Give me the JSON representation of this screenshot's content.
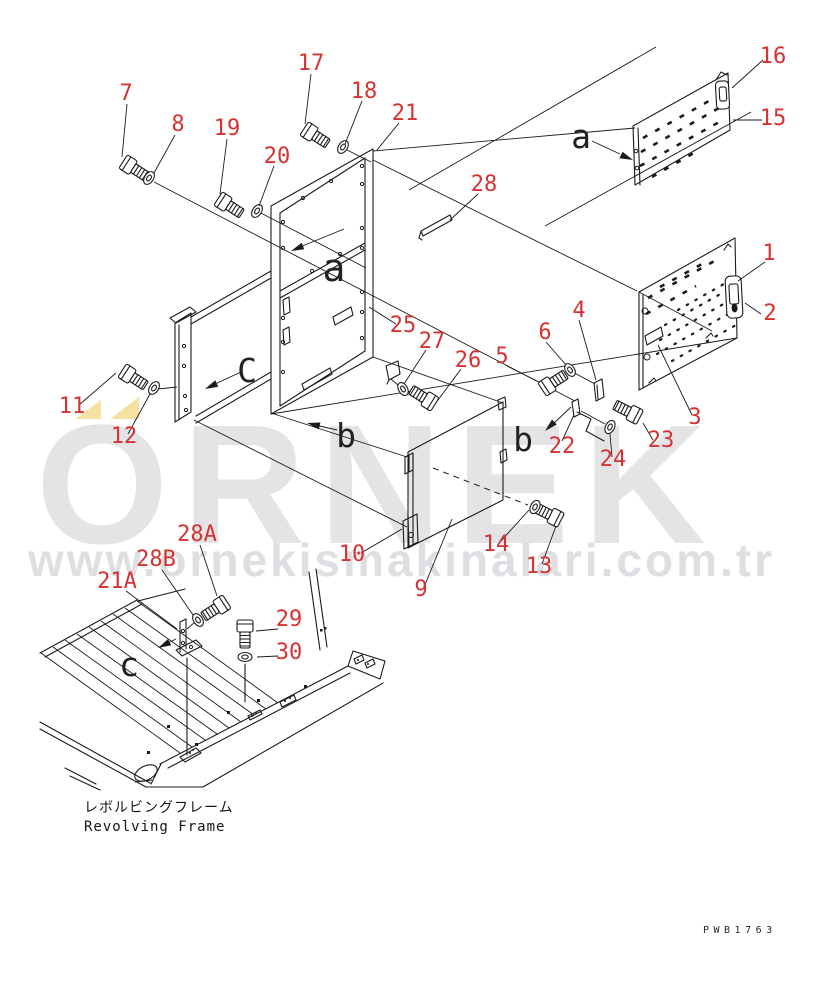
{
  "page": {
    "background": "#ffffff"
  },
  "diagram": {
    "type": "exploded-parts-diagram",
    "subject": {
      "caption_jp": "レボルビングフレーム",
      "caption_en": "Revolving Frame"
    },
    "drawing_number": "PWB1763",
    "colors": {
      "callout": "#d63232",
      "line": "#1b1b1b",
      "letter": "#222222"
    },
    "callouts": [
      "1",
      "2",
      "3",
      "4",
      "5",
      "6",
      "7",
      "8",
      "9",
      "10",
      "11",
      "12",
      "13",
      "14",
      "15",
      "16",
      "17",
      "18",
      "19",
      "20",
      "21",
      "21A",
      "22",
      "23",
      "24",
      "25",
      "26",
      "27",
      "28",
      "28A",
      "28B",
      "29",
      "30"
    ],
    "view_labels": [
      "a",
      "a",
      "b",
      "b",
      "C",
      "c"
    ]
  },
  "watermark": {
    "brand": "ORNEK",
    "url": "www.ornekismakinalari.com.tr",
    "text_color": "#e4e4e7",
    "accent_color": "#f7e1a1"
  }
}
